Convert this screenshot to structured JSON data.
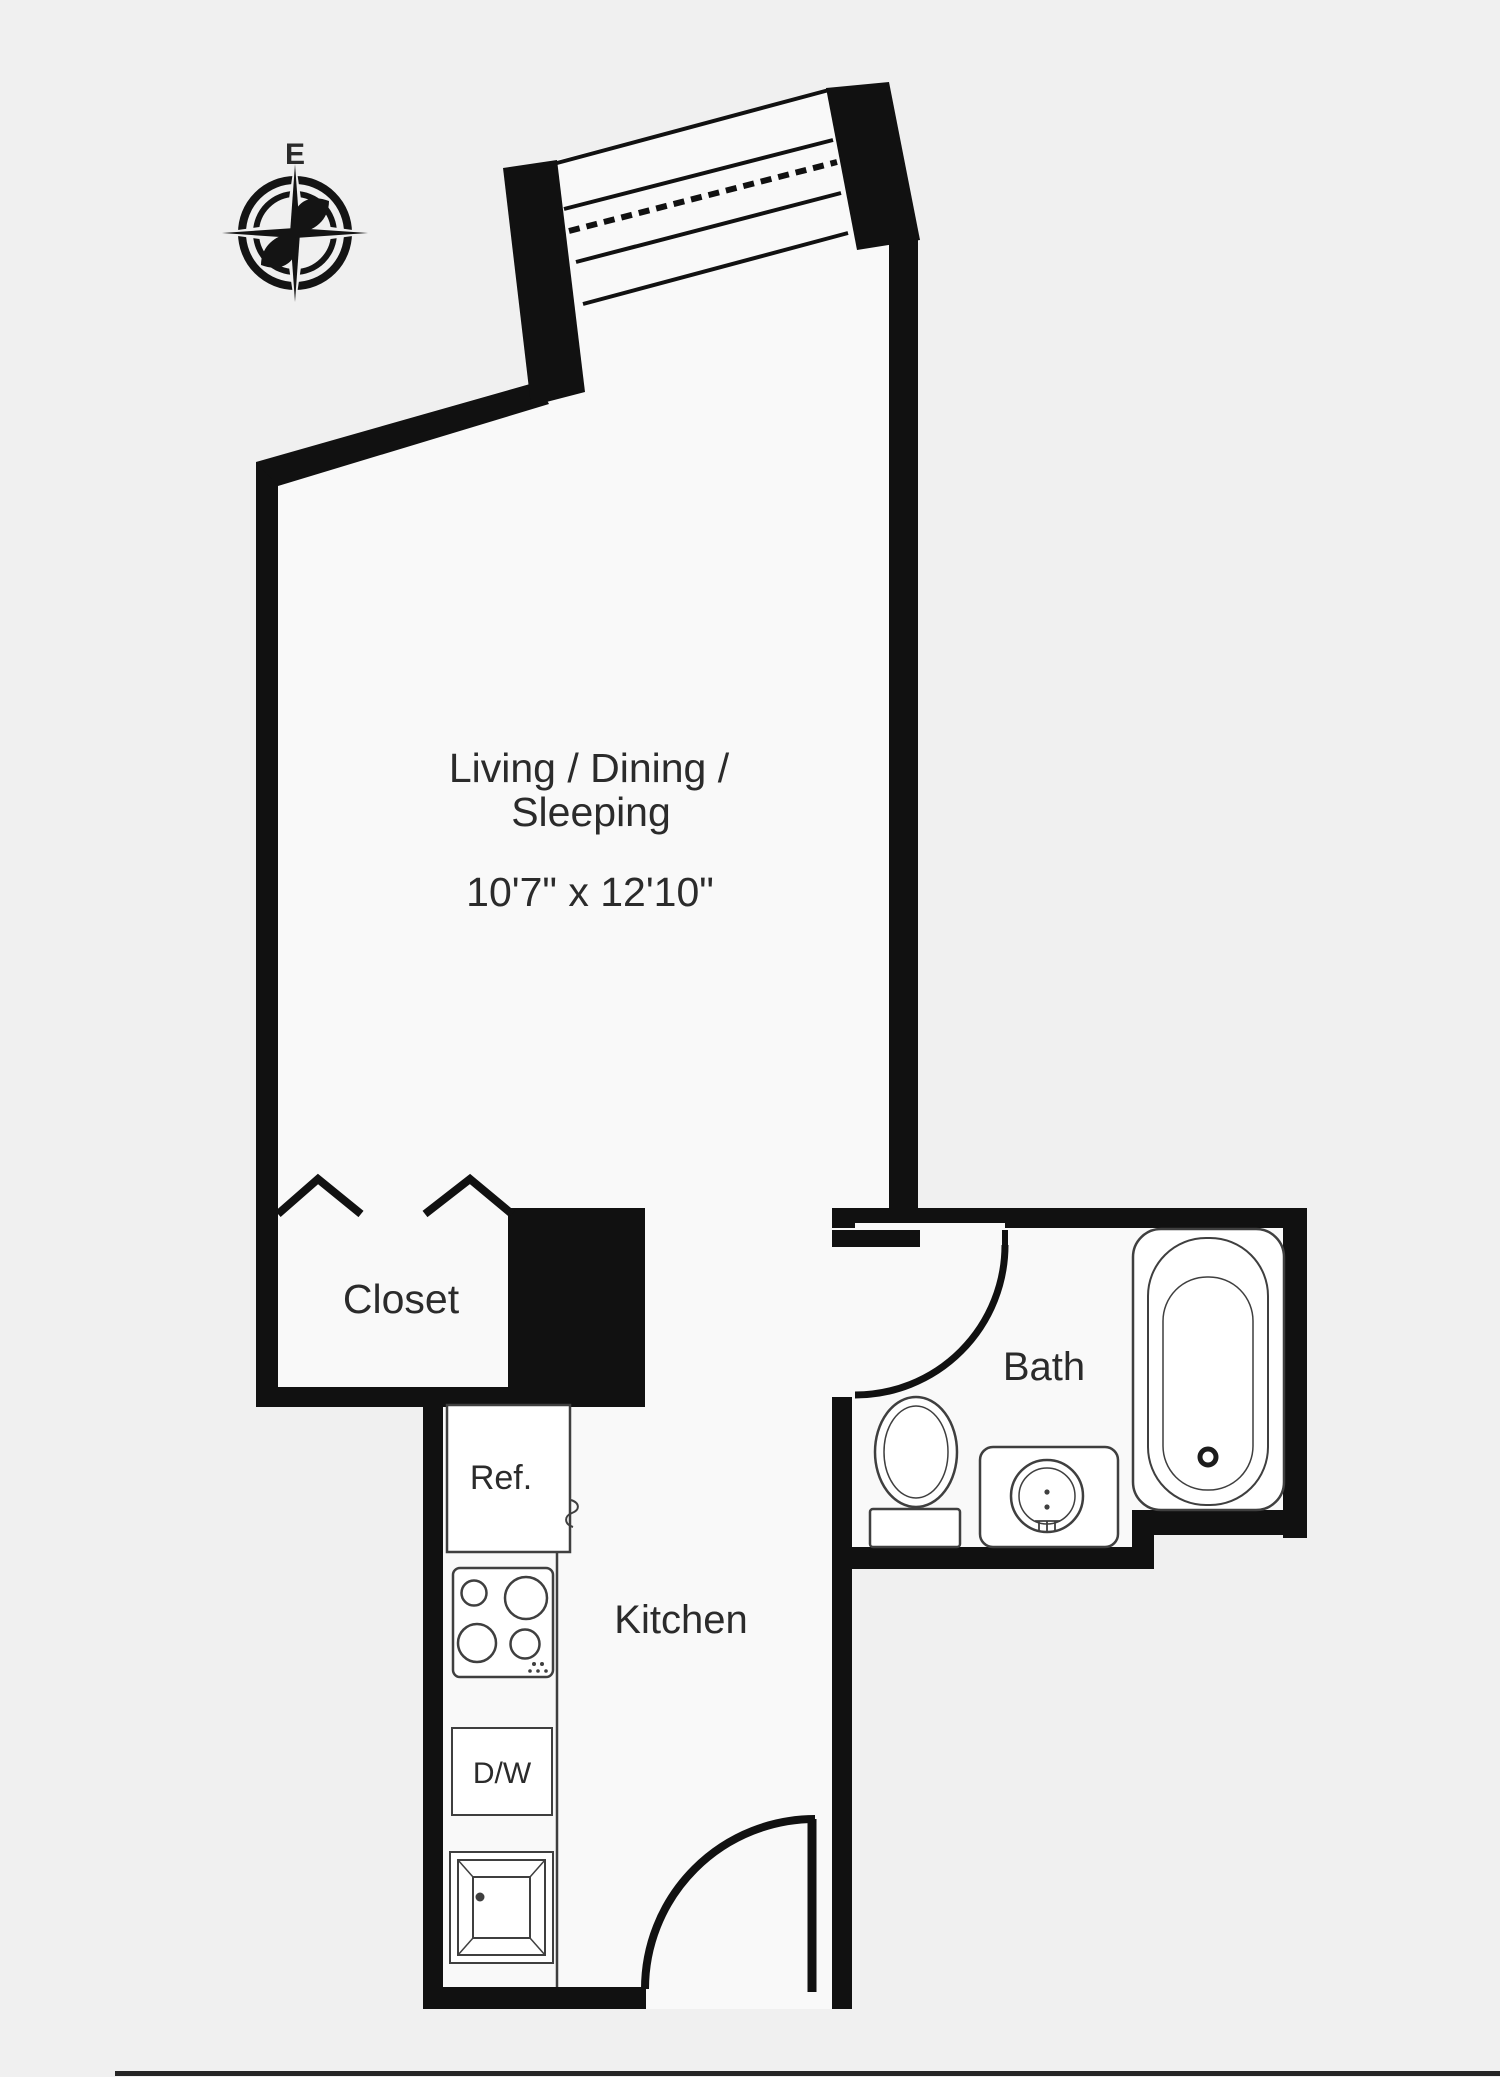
{
  "plan": {
    "compass": {
      "direction_label": "E"
    },
    "rooms": {
      "living": {
        "name_line1": "Living / Dining /",
        "name_line2": "Sleeping",
        "dimensions": "10'7\" x 12'10\""
      },
      "closet": {
        "label": "Closet"
      },
      "kitchen": {
        "label": "Kitchen"
      },
      "bath": {
        "label": "Bath"
      }
    },
    "fixtures": {
      "refrigerator": {
        "label": "Ref."
      },
      "dishwasher": {
        "label": "D/W"
      }
    },
    "colors": {
      "wall": "#111111",
      "background": "#f0f0f0",
      "floor": "#f9f9f9",
      "fixture_line": "#3f3f3f",
      "text": "#2b2b2b"
    }
  }
}
